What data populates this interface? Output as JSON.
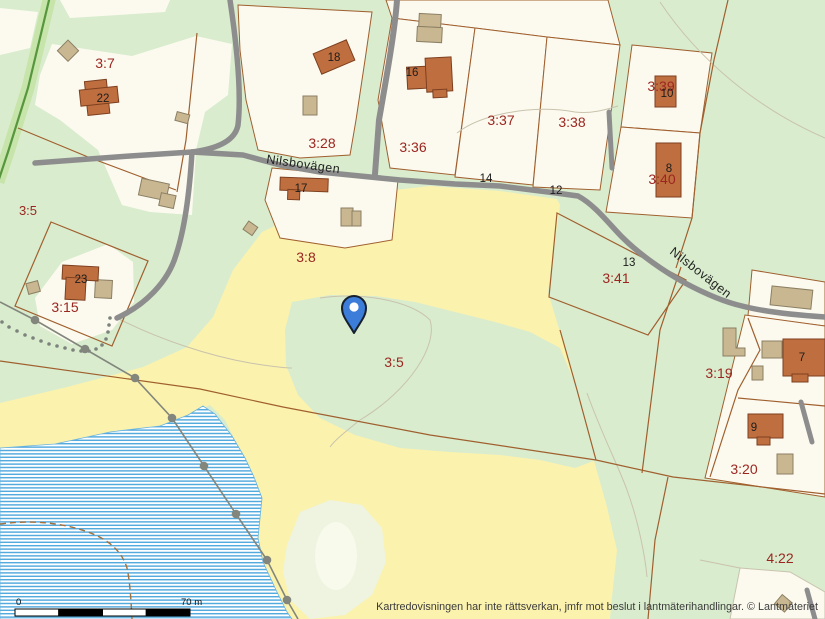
{
  "map": {
    "attribution": "Kartredovisningen har inte rättsverkan, jmfr mot beslut i lantmäterihandlingar. © Lantmäteriet",
    "road_labels": [
      "Nilsbovägen",
      "Nilsbovägen"
    ],
    "parcel_labels": [
      "3:7",
      "3:5",
      "3:28",
      "3:36",
      "3:37",
      "3:38",
      "3:39",
      "3:40",
      "3:8",
      "3:15",
      "3:41",
      "3:5",
      "3:19",
      "3:20",
      "4:22"
    ],
    "building_numbers": [
      "22",
      "18",
      "16",
      "17",
      "23",
      "10",
      "8",
      "7",
      "9"
    ],
    "address_numbers": [
      "14",
      "12",
      "13"
    ],
    "scale_bar": {
      "start_label": "0",
      "end_label": "70 m"
    },
    "marker": {
      "type": "location-pin"
    },
    "colors": {
      "forest_green": "#d9ecce",
      "field_yellow": "#fbf2ae",
      "parcel_white": "#fcfaef",
      "water_blue": "#4da7dc",
      "building_main": "#bf6f3f",
      "building_outbuilding": "#c9b791",
      "road_gray": "#8d8d8d",
      "boundary_brown": "#a05f2e",
      "label_red": "#9b2620",
      "marker_blue": "#3b7dd8"
    }
  }
}
